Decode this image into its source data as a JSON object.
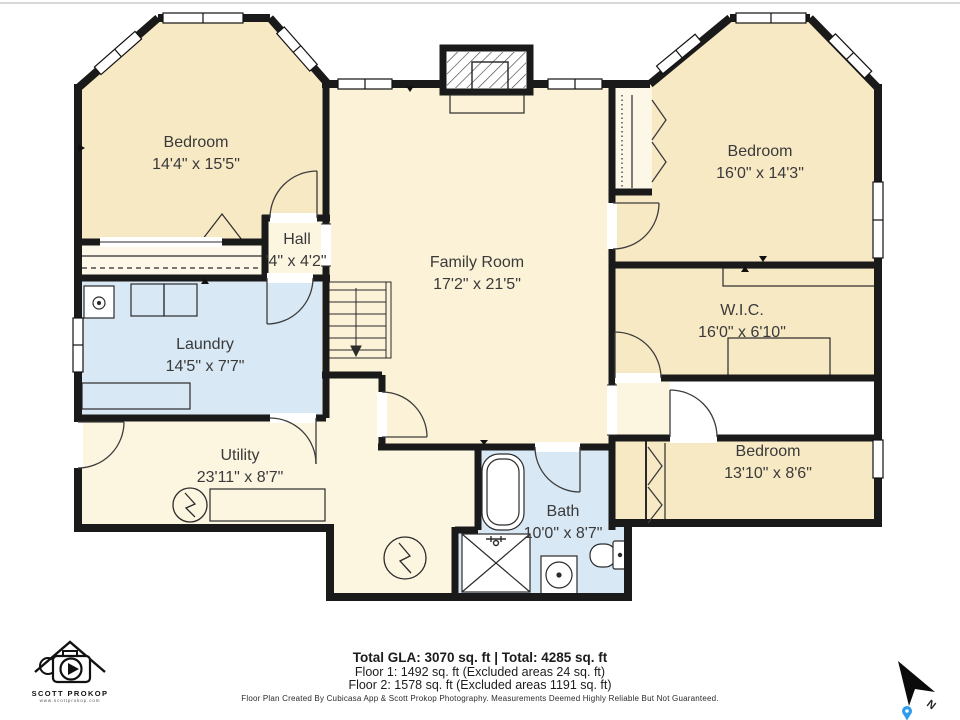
{
  "rooms": {
    "bedroom_tl": {
      "name": "Bedroom",
      "dims": "14'4\" x 15'5\""
    },
    "bedroom_tr": {
      "name": "Bedroom",
      "dims": "16'0\" x 14'3\""
    },
    "family_room": {
      "name": "Family Room",
      "dims": "17'2\" x 21'5\""
    },
    "hall": {
      "name": "Hall",
      "dims": "'4\" x 4'2\""
    },
    "wic": {
      "name": "W.I.C.",
      "dims": "16'0\" x 6'10\""
    },
    "laundry": {
      "name": "Laundry",
      "dims": "14'5\" x 7'7\""
    },
    "utility": {
      "name": "Utility",
      "dims": "23'11\" x 8'7\""
    },
    "bath": {
      "name": "Bath",
      "dims": "10'0\" x 8'7\""
    },
    "bedroom_br": {
      "name": "Bedroom",
      "dims": "13'10\" x 8'6\""
    }
  },
  "footer": {
    "totals": "Total GLA: 3070 sq. ft | Total: 4285 sq. ft",
    "floor1": "Floor 1: 1492 sq. ft (Excluded areas 24 sq. ft)",
    "floor2": "Floor 2: 1578 sq. ft (Excluded areas 1191 sq. ft)",
    "disclaimer": "Floor Plan Created By Cubicasa App & Scott Prokop Photography. Measurements Deemed Highly Reliable But Not Guaranteed."
  },
  "branding": {
    "name": "SCOTT PROKOP",
    "url": "www.scottprokop.com"
  },
  "compass": {
    "north_label": "N"
  },
  "colors": {
    "wall": "#1a1a1a",
    "bedroom_fill": "#f8e9c5",
    "family_fill": "#fbf2d7",
    "light_fill": "#fcf5e0",
    "wet_fill": "#d8e8f4",
    "closet_fill": "#fdf7e8",
    "pin_blue": "#2f9bec"
  }
}
